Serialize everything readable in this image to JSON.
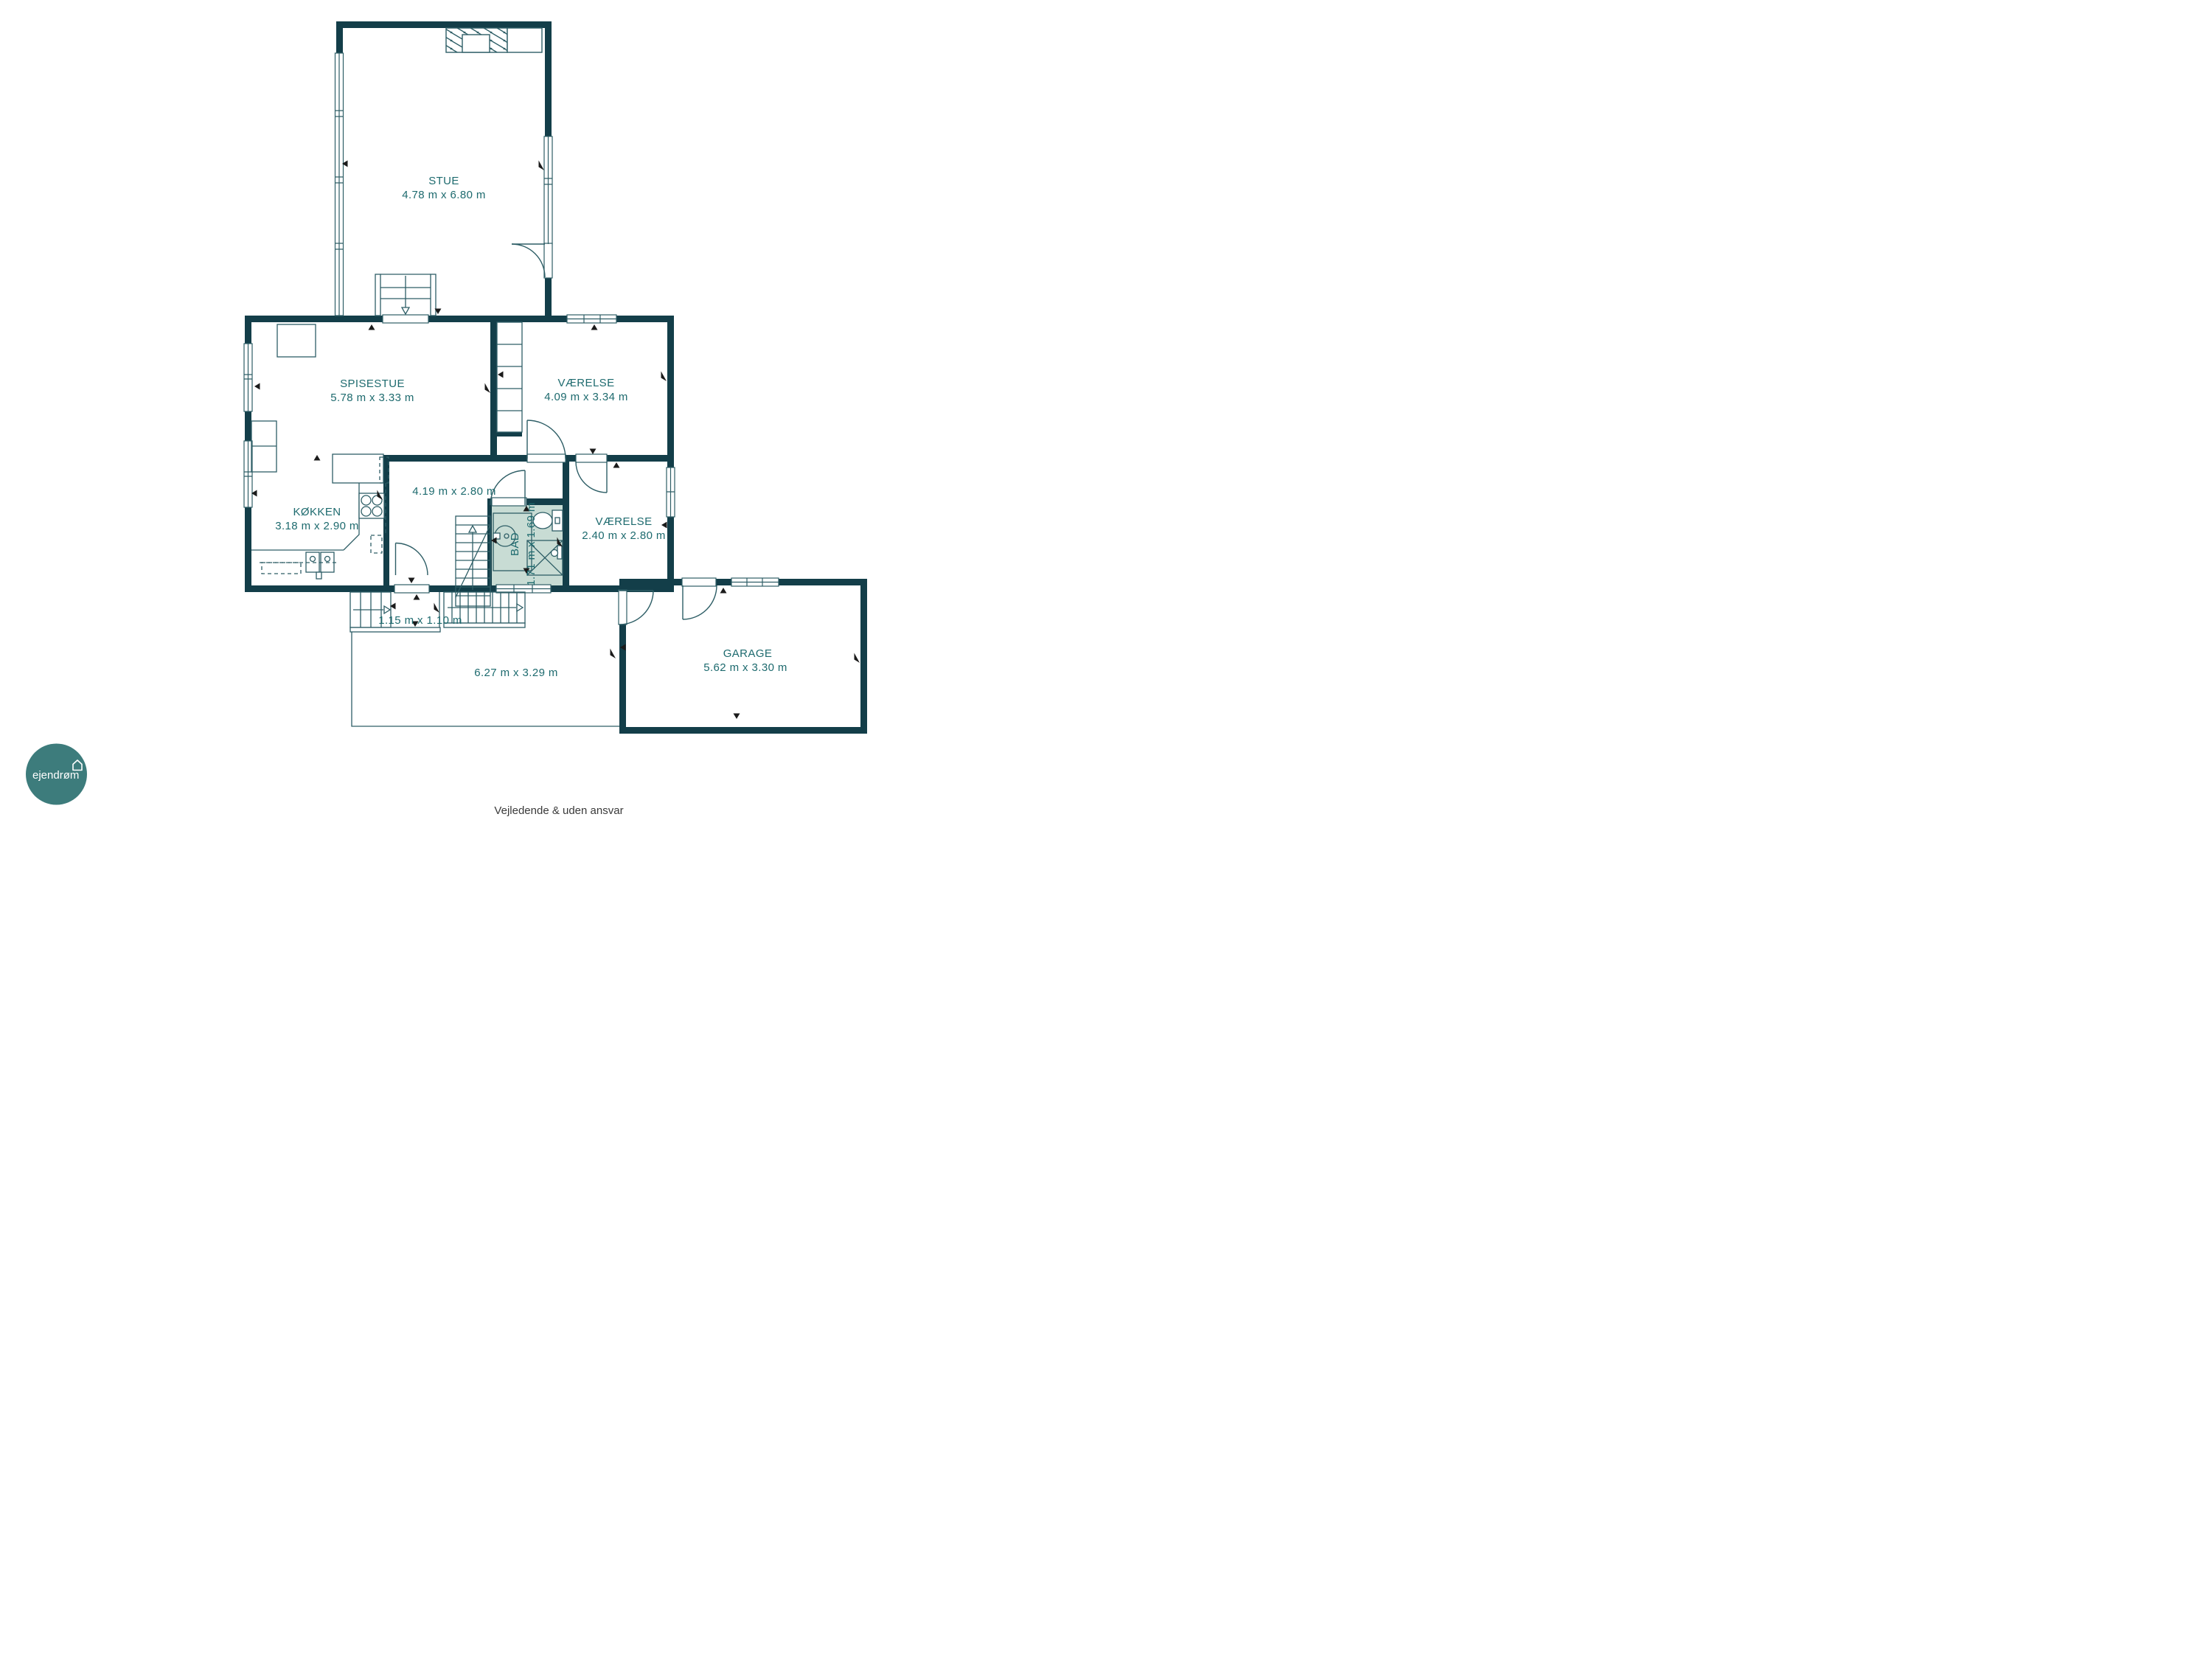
{
  "plan": {
    "rooms": [
      {
        "id": "stue",
        "name": "STUE",
        "dims": "4.78 m x 6.80 m"
      },
      {
        "id": "spisestue",
        "name": "SPISESTUE",
        "dims": "5.78 m x 3.33 m"
      },
      {
        "id": "vaerelse-nord",
        "name": "VÆRELSE",
        "dims": "4.09 m x 3.34 m"
      },
      {
        "id": "koekken",
        "name": "KØKKEN",
        "dims": "3.18 m x 2.90 m"
      },
      {
        "id": "gang",
        "name": "",
        "dims": "4.19 m x 2.80 m"
      },
      {
        "id": "bad",
        "name": "BAD",
        "dims": "1.71 m x 1.69 m"
      },
      {
        "id": "vaerelse-syd",
        "name": "VÆRELSE",
        "dims": "2.40 m x 2.80 m"
      },
      {
        "id": "repos",
        "name": "",
        "dims": "1.15 m x 1.10 m"
      },
      {
        "id": "terrasse",
        "name": "",
        "dims": "6.27 m x 3.29 m"
      },
      {
        "id": "garage",
        "name": "GARAGE",
        "dims": "5.62 m x 3.30 m"
      }
    ],
    "colors": {
      "wall": "#133e49",
      "thin_line": "#2e5e66",
      "room_label": "#1d6a6e",
      "bath_fill": "#c8dcd4",
      "logo_circle": "#3d7c7c",
      "footer_text": "#3a3a3a"
    },
    "logo": {
      "text": "ejendrøm"
    },
    "footer": {
      "disclaimer": "Vejledende & uden ansvar"
    }
  }
}
